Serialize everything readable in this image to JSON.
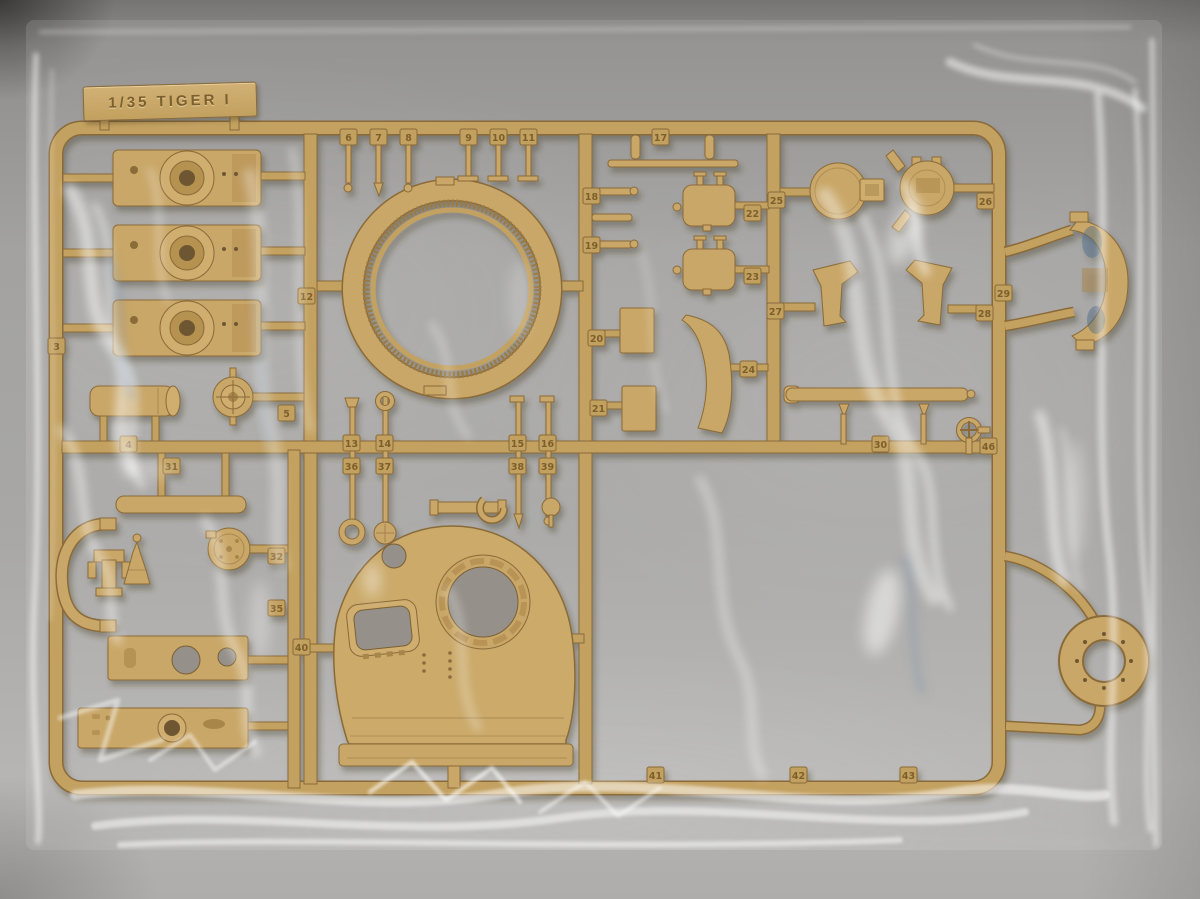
{
  "meta": {
    "subject": "Dark-yellow plastic model kit sprue with Tiger I tank turret parts, sealed in a clear plastic bag, photographed on a grey surface"
  },
  "sprue": {
    "label": "1/35 TIGER I",
    "part_tags": [
      {
        "num": "3",
        "x": 48,
        "y": 338
      },
      {
        "num": "4",
        "x": 120,
        "y": 436
      },
      {
        "num": "31",
        "x": 163,
        "y": 458
      },
      {
        "num": "5",
        "x": 278,
        "y": 405
      },
      {
        "num": "12",
        "x": 298,
        "y": 288
      },
      {
        "num": "6",
        "x": 340,
        "y": 129
      },
      {
        "num": "7",
        "x": 370,
        "y": 129
      },
      {
        "num": "8",
        "x": 400,
        "y": 129
      },
      {
        "num": "9",
        "x": 460,
        "y": 129
      },
      {
        "num": "10",
        "x": 490,
        "y": 129
      },
      {
        "num": "11",
        "x": 520,
        "y": 129
      },
      {
        "num": "13",
        "x": 343,
        "y": 435
      },
      {
        "num": "36",
        "x": 343,
        "y": 458
      },
      {
        "num": "14",
        "x": 376,
        "y": 435
      },
      {
        "num": "37",
        "x": 376,
        "y": 458
      },
      {
        "num": "15",
        "x": 509,
        "y": 435
      },
      {
        "num": "38",
        "x": 509,
        "y": 458
      },
      {
        "num": "16",
        "x": 539,
        "y": 435
      },
      {
        "num": "39",
        "x": 539,
        "y": 458
      },
      {
        "num": "17",
        "x": 652,
        "y": 129
      },
      {
        "num": "18",
        "x": 583,
        "y": 188
      },
      {
        "num": "19",
        "x": 583,
        "y": 237
      },
      {
        "num": "20",
        "x": 588,
        "y": 330
      },
      {
        "num": "21",
        "x": 590,
        "y": 400
      },
      {
        "num": "22",
        "x": 744,
        "y": 205
      },
      {
        "num": "23",
        "x": 744,
        "y": 268
      },
      {
        "num": "24",
        "x": 740,
        "y": 361
      },
      {
        "num": "25",
        "x": 768,
        "y": 192
      },
      {
        "num": "26",
        "x": 977,
        "y": 193
      },
      {
        "num": "27",
        "x": 767,
        "y": 303
      },
      {
        "num": "28",
        "x": 976,
        "y": 305
      },
      {
        "num": "29",
        "x": 995,
        "y": 285
      },
      {
        "num": "30",
        "x": 872,
        "y": 436
      },
      {
        "num": "46",
        "x": 980,
        "y": 438
      },
      {
        "num": "32",
        "x": 268,
        "y": 548
      },
      {
        "num": "35",
        "x": 268,
        "y": 600
      },
      {
        "num": "40",
        "x": 293,
        "y": 639
      },
      {
        "num": "41",
        "x": 647,
        "y": 767
      },
      {
        "num": "42",
        "x": 790,
        "y": 767
      },
      {
        "num": "43",
        "x": 900,
        "y": 767
      }
    ]
  },
  "colors": {
    "backdrop_top": "#757472",
    "backdrop_mid": "#a3a2a0",
    "backdrop_bottom": "#b6b5b3",
    "sprue": "#c3a161",
    "sprue_dark": "#8a6a38",
    "sprue_light": "#d8bd82",
    "hole": "#95908a",
    "tag_text": "#7a5c2a",
    "bag_highlight": "#ffffff"
  }
}
